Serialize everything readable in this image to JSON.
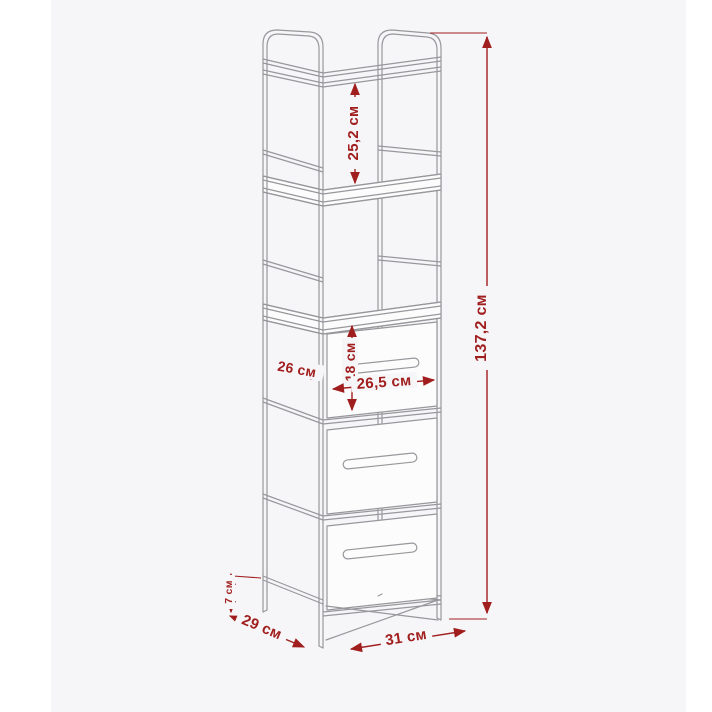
{
  "image": {
    "page_background": "#ffffff",
    "background_panel_color": "#f6f6f8"
  },
  "diagram": {
    "subject": "tall-shelf-unit-with-three-fabric-drawers",
    "measurement_unit": "см",
    "colors": {
      "dimension_red": "#a01e1e",
      "line_gray": "#98989c",
      "surface_white": "#fcfcfd"
    },
    "dimensions": {
      "shelf_spacing": "25,2 см",
      "total_height": "137,2 см",
      "side_depth": "26 см",
      "drawer_height": "18 см",
      "drawer_width": "26,5 см",
      "leg_height": "7 см",
      "depth": "29 см",
      "width": "31 см"
    }
  }
}
